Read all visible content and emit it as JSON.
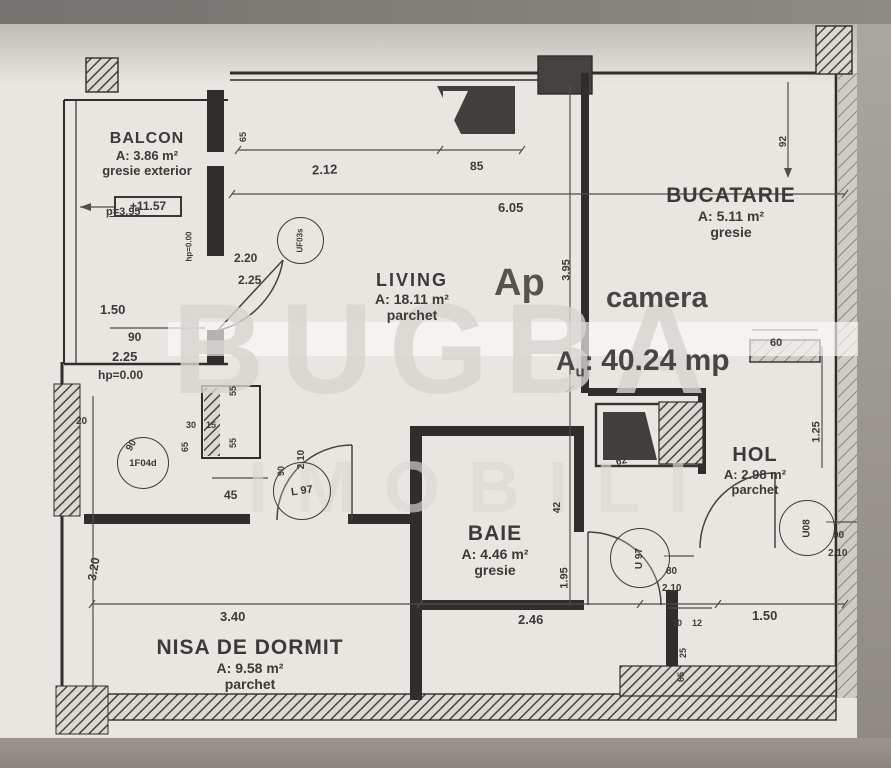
{
  "watermark": {
    "line1": "BUGBA",
    "line2": "IMOBILI"
  },
  "summary": {
    "ap": "Ap",
    "camera": "camera",
    "au_a": "A",
    "au_sub": "u",
    "au_colon": ":",
    "au_value": "40.24 mp"
  },
  "rooms": [
    {
      "name": "BALCON",
      "area": "A: 3.86 m²",
      "floor": "gresie exterior"
    },
    {
      "name": "LIVING",
      "area": "A: 18.11 m²",
      "floor": "parchet"
    },
    {
      "name": "BUCATARIE",
      "area": "A: 5.11 m²",
      "floor": "gresie"
    },
    {
      "name": "HOL",
      "area": "A: 2.98 m²",
      "floor": "parchet"
    },
    {
      "name": "BAIE",
      "area": "A: 4.46 m²",
      "floor": "gresie"
    },
    {
      "name": "NISA DE DORMIT",
      "area": "A: 9.58 m²",
      "floor": "parchet"
    }
  ],
  "balcony": {
    "elevation": "+11.57"
  },
  "door_tags": [
    {
      "id": "UF03s"
    },
    {
      "id": "1F04d"
    },
    {
      "id": "L 97"
    },
    {
      "id": "U 97"
    },
    {
      "id": "U08"
    }
  ],
  "dims": [
    {
      "t": "2.12",
      "x": 312,
      "y": 138,
      "r": -2,
      "s": 13
    },
    {
      "t": "85",
      "x": 470,
      "y": 135,
      "r": -2,
      "s": 12
    },
    {
      "t": "6.05",
      "x": 498,
      "y": 176,
      "r": 0,
      "s": 13
    },
    {
      "t": "65",
      "x": 238,
      "y": 108,
      "r": -90,
      "s": 9
    },
    {
      "t": "92",
      "x": 778,
      "y": 112,
      "r": -90,
      "s": 10
    },
    {
      "t": "2.20",
      "x": 234,
      "y": 227,
      "r": 0,
      "s": 12
    },
    {
      "t": "2.25",
      "x": 238,
      "y": 249,
      "r": 0,
      "s": 12
    },
    {
      "t": "1.50",
      "x": 100,
      "y": 278,
      "r": 0,
      "s": 13
    },
    {
      "t": "90",
      "x": 128,
      "y": 306,
      "r": 0,
      "s": 12
    },
    {
      "t": "2.25",
      "x": 112,
      "y": 325,
      "r": 0,
      "s": 13
    },
    {
      "t": "hp=0.00",
      "x": 98,
      "y": 344,
      "r": 0,
      "s": 12
    },
    {
      "t": "p=3.95",
      "x": 106,
      "y": 182,
      "r": 0,
      "s": 11,
      "st": 1
    },
    {
      "t": "hp=0.00",
      "x": 174,
      "y": 218,
      "r": -90,
      "s": 8
    },
    {
      "t": "3.95",
      "x": 556,
      "y": 240,
      "r": -90,
      "s": 11
    },
    {
      "t": "1.95",
      "x": 554,
      "y": 548,
      "r": -90,
      "s": 11
    },
    {
      "t": "60",
      "x": 770,
      "y": 313,
      "r": 0,
      "s": 11
    },
    {
      "t": "1.25",
      "x": 806,
      "y": 402,
      "r": -90,
      "s": 11
    },
    {
      "t": "20",
      "x": 76,
      "y": 392,
      "r": 0,
      "s": 10
    },
    {
      "t": "3.20",
      "x": 82,
      "y": 538,
      "r": -80,
      "s": 12
    },
    {
      "t": "55",
      "x": 228,
      "y": 362,
      "r": -90,
      "s": 9
    },
    {
      "t": "30",
      "x": 186,
      "y": 396,
      "r": 0,
      "s": 9
    },
    {
      "t": "15",
      "x": 206,
      "y": 396,
      "r": 0,
      "s": 9
    },
    {
      "t": "65",
      "x": 180,
      "y": 418,
      "r": -90,
      "s": 9
    },
    {
      "t": "55",
      "x": 228,
      "y": 414,
      "r": -90,
      "s": 9
    },
    {
      "t": "90",
      "x": 126,
      "y": 416,
      "r": -60,
      "s": 10
    },
    {
      "t": "45",
      "x": 224,
      "y": 464,
      "r": 0,
      "s": 12
    },
    {
      "t": "90",
      "x": 276,
      "y": 442,
      "r": -90,
      "s": 9
    },
    {
      "t": "2.10",
      "x": 292,
      "y": 430,
      "r": -90,
      "s": 10
    },
    {
      "t": "42",
      "x": 552,
      "y": 478,
      "r": -90,
      "s": 10
    },
    {
      "t": "62",
      "x": 616,
      "y": 432,
      "r": -12,
      "s": 10
    },
    {
      "t": "2.46",
      "x": 518,
      "y": 588,
      "r": 0,
      "s": 13
    },
    {
      "t": "3.40",
      "x": 220,
      "y": 585,
      "r": 0,
      "s": 13
    },
    {
      "t": "1.50",
      "x": 752,
      "y": 584,
      "r": 0,
      "s": 13
    },
    {
      "t": "10",
      "x": 672,
      "y": 594,
      "r": 0,
      "s": 9
    },
    {
      "t": "12",
      "x": 692,
      "y": 594,
      "r": 0,
      "s": 9
    },
    {
      "t": "25",
      "x": 678,
      "y": 624,
      "r": -90,
      "s": 9
    },
    {
      "t": "65",
      "x": 676,
      "y": 648,
      "r": -90,
      "s": 9
    },
    {
      "t": "80",
      "x": 666,
      "y": 542,
      "r": 0,
      "s": 10
    },
    {
      "t": "2.10",
      "x": 662,
      "y": 559,
      "r": 0,
      "s": 10
    },
    {
      "t": "90",
      "x": 833,
      "y": 506,
      "r": 0,
      "s": 10
    },
    {
      "t": "2.10",
      "x": 828,
      "y": 524,
      "r": 0,
      "s": 10
    }
  ]
}
